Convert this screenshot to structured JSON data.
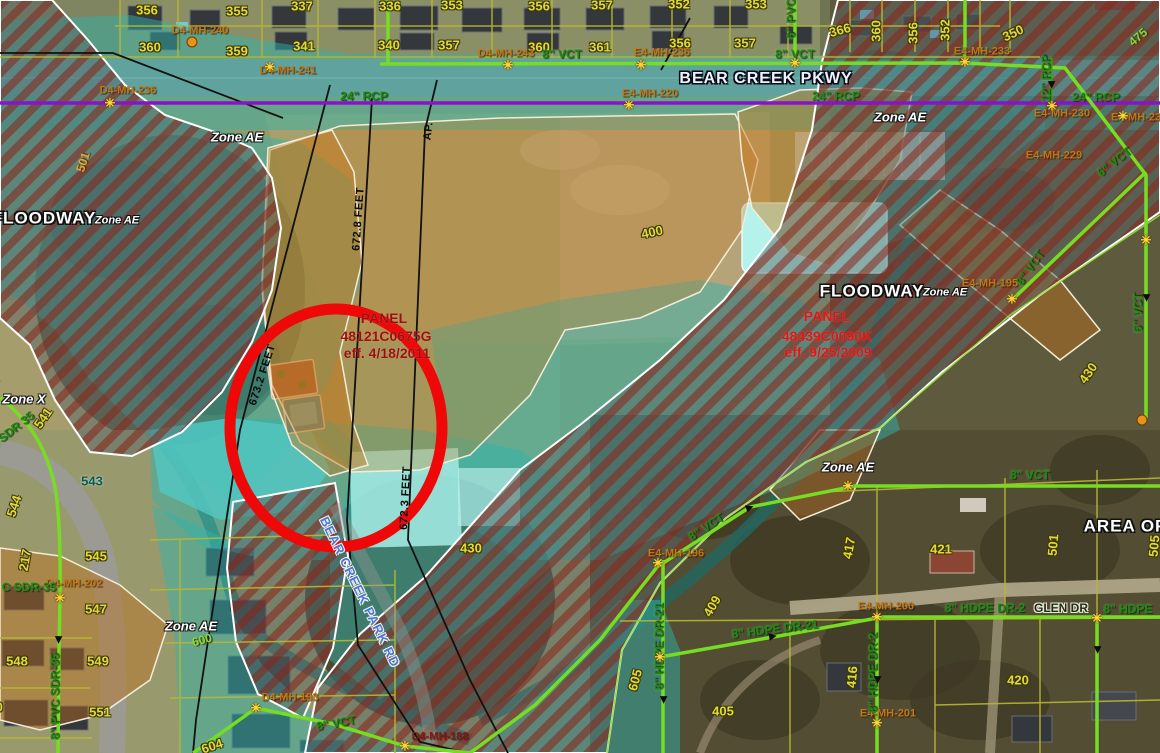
{
  "colors": {
    "zone_teal": "#2fb4ad",
    "floodway_stripe": "#8c2418",
    "orange_zone": "#cf841c",
    "pipe_green": "#76dd22",
    "storm_purple": "#8a12c8",
    "annotation_red": "#ee0808",
    "parcel_yellow": "#e3d83f",
    "mh_orange": "#c07818",
    "panel_dark_red": "#9e1010",
    "panel_bright_red": "#e41414",
    "road_blue": "#4a78d8"
  },
  "panels": {
    "left": {
      "title": "PANEL",
      "number": "48121C0675G",
      "effective": "eff. 4/18/2011"
    },
    "right": {
      "title": "PANEL",
      "number": "48439C0090K",
      "effective": "eff. 9/25/2009"
    }
  },
  "labels": [
    {
      "t": "Zone AE",
      "x": 237,
      "y": 137,
      "c": "zl",
      "n": "zone-ae-label"
    },
    {
      "t": "Zone AE",
      "x": 900,
      "y": 117,
      "c": "zl",
      "n": "zone-ae-label"
    },
    {
      "t": "Zone AE",
      "x": 848,
      "y": 467,
      "c": "zl",
      "n": "zone-ae-label"
    },
    {
      "t": "Zone AE",
      "x": 191,
      "y": 626,
      "c": "zl",
      "n": "zone-ae-label"
    },
    {
      "t": "Zone X",
      "x": 24,
      "y": 399,
      "c": "zl",
      "n": "zone-x-label"
    },
    {
      "t": "FLOODWAY",
      "x": 44,
      "y": 218,
      "c": "fw",
      "n": "floodway-label"
    },
    {
      "t": "Zone AE",
      "x": 117,
      "y": 221,
      "c": "fwz",
      "n": "floodway-zone-label"
    },
    {
      "t": "FLOODWAY",
      "x": 872,
      "y": 291,
      "c": "fw",
      "n": "floodway-label"
    },
    {
      "t": "Zone AE",
      "x": 945,
      "y": 293,
      "c": "fwz",
      "n": "floodway-zone-label"
    },
    {
      "t": "AREA OF",
      "x": 1125,
      "y": 526,
      "c": "fw",
      "n": "area-of-label"
    },
    {
      "t": "PANEL",
      "x": 384,
      "y": 318,
      "c": "p1",
      "n": "panel-title"
    },
    {
      "t": "48121C0675G",
      "x": 386,
      "y": 336,
      "c": "p1",
      "n": "panel-number"
    },
    {
      "t": "eff. 4/18/2011",
      "x": 387,
      "y": 353,
      "c": "p1",
      "n": "panel-effective-date"
    },
    {
      "t": "PANEL",
      "x": 827,
      "y": 316,
      "c": "p2",
      "n": "panel-title"
    },
    {
      "t": "48439C0090K",
      "x": 827,
      "y": 336,
      "c": "p2",
      "n": "panel-number"
    },
    {
      "t": "eff. 9/25/2009",
      "x": 828,
      "y": 352,
      "c": "p2",
      "n": "panel-effective-date"
    },
    {
      "t": "BEAR CREEK PKWY",
      "x": 766,
      "y": 79,
      "c": "st1",
      "n": "street-label"
    },
    {
      "t": "BEAR CREEK PARK RD",
      "x": 360,
      "y": 592,
      "r": 64,
      "c": "st2",
      "n": "street-label"
    },
    {
      "t": "GLEN DR",
      "x": 1061,
      "y": 608,
      "c": "st3",
      "n": "street-label"
    },
    {
      "t": "356",
      "x": 147,
      "y": 10,
      "c": "pc",
      "n": "parcel-label"
    },
    {
      "t": "355",
      "x": 237,
      "y": 11,
      "c": "pc",
      "n": "parcel-label"
    },
    {
      "t": "337",
      "x": 302,
      "y": 6,
      "c": "pc",
      "n": "parcel-label"
    },
    {
      "t": "336",
      "x": 390,
      "y": 6,
      "c": "pc",
      "n": "parcel-label"
    },
    {
      "t": "353",
      "x": 452,
      "y": 5,
      "c": "pc",
      "n": "parcel-label"
    },
    {
      "t": "356",
      "x": 539,
      "y": 6,
      "c": "pc",
      "n": "parcel-label"
    },
    {
      "t": "357",
      "x": 602,
      "y": 5,
      "c": "pc",
      "n": "parcel-label"
    },
    {
      "t": "352",
      "x": 679,
      "y": 4,
      "c": "pc",
      "n": "parcel-label"
    },
    {
      "t": "353",
      "x": 756,
      "y": 4,
      "c": "pc",
      "n": "parcel-label"
    },
    {
      "t": "360",
      "x": 150,
      "y": 47,
      "c": "pc",
      "n": "parcel-label"
    },
    {
      "t": "359",
      "x": 237,
      "y": 51,
      "c": "pc",
      "n": "parcel-label"
    },
    {
      "t": "341",
      "x": 304,
      "y": 46,
      "c": "pc",
      "n": "parcel-label"
    },
    {
      "t": "340",
      "x": 389,
      "y": 45,
      "c": "pc",
      "n": "parcel-label"
    },
    {
      "t": "357",
      "x": 449,
      "y": 45,
      "c": "pc",
      "n": "parcel-label"
    },
    {
      "t": "360",
      "x": 539,
      "y": 47,
      "c": "pc",
      "n": "parcel-label"
    },
    {
      "t": "361",
      "x": 600,
      "y": 47,
      "c": "pc",
      "n": "parcel-label"
    },
    {
      "t": "356",
      "x": 680,
      "y": 43,
      "c": "pc",
      "n": "parcel-label"
    },
    {
      "t": "357",
      "x": 745,
      "y": 43,
      "c": "pc",
      "n": "parcel-label"
    },
    {
      "t": "366",
      "x": 840,
      "y": 30,
      "r": -15,
      "c": "pc",
      "n": "parcel-label"
    },
    {
      "t": "360",
      "x": 876,
      "y": 31,
      "r": -90,
      "c": "pc",
      "n": "parcel-label"
    },
    {
      "t": "356",
      "x": 913,
      "y": 33,
      "r": -90,
      "c": "pc",
      "n": "parcel-label"
    },
    {
      "t": "352",
      "x": 945,
      "y": 30,
      "r": -90,
      "c": "pc",
      "n": "parcel-label"
    },
    {
      "t": "350",
      "x": 1013,
      "y": 33,
      "r": -25,
      "c": "pc",
      "n": "parcel-label"
    },
    {
      "t": "539",
      "x": -8,
      "y": 388,
      "r": -70,
      "c": "pc",
      "n": "parcel-label"
    },
    {
      "t": "541",
      "x": 43,
      "y": 418,
      "r": -55,
      "c": "pc",
      "n": "parcel-label"
    },
    {
      "t": "543",
      "x": 92,
      "y": 481,
      "c": "pcd",
      "n": "parcel-label"
    },
    {
      "t": "544",
      "x": 14,
      "y": 506,
      "r": -72,
      "c": "pc",
      "n": "parcel-label"
    },
    {
      "t": "217",
      "x": 25,
      "y": 560,
      "r": -80,
      "c": "pc",
      "n": "parcel-label"
    },
    {
      "t": "545",
      "x": 96,
      "y": 556,
      "c": "pc",
      "n": "parcel-label"
    },
    {
      "t": "547",
      "x": 96,
      "y": 609,
      "c": "pc",
      "n": "parcel-label"
    },
    {
      "t": "548",
      "x": 17,
      "y": 661,
      "c": "pc",
      "n": "parcel-label"
    },
    {
      "t": "549",
      "x": 98,
      "y": 661,
      "c": "pc",
      "n": "parcel-label"
    },
    {
      "t": "550",
      "x": -8,
      "y": 707,
      "c": "pc",
      "n": "parcel-label"
    },
    {
      "t": "551",
      "x": 100,
      "y": 712,
      "c": "pc",
      "n": "parcel-label"
    },
    {
      "t": "605",
      "x": 635,
      "y": 680,
      "r": -75,
      "c": "pc",
      "n": "parcel-label"
    },
    {
      "t": "400",
      "x": 652,
      "y": 232,
      "r": -12,
      "c": "pc",
      "n": "parcel-label"
    },
    {
      "t": "430",
      "x": 471,
      "y": 548,
      "c": "pc",
      "n": "parcel-label"
    },
    {
      "t": "430",
      "x": 1088,
      "y": 373,
      "r": -55,
      "c": "pc",
      "n": "parcel-label"
    },
    {
      "t": "417",
      "x": 849,
      "y": 548,
      "r": -80,
      "c": "pc",
      "n": "parcel-label"
    },
    {
      "t": "421",
      "x": 941,
      "y": 549,
      "c": "pc",
      "n": "parcel-label"
    },
    {
      "t": "501",
      "x": 1053,
      "y": 545,
      "r": -85,
      "c": "pc",
      "n": "parcel-label"
    },
    {
      "t": "505",
      "x": 1154,
      "y": 546,
      "r": -85,
      "c": "pc",
      "n": "parcel-label"
    },
    {
      "t": "416",
      "x": 852,
      "y": 677,
      "r": -85,
      "c": "pc",
      "n": "parcel-label"
    },
    {
      "t": "409",
      "x": 712,
      "y": 606,
      "r": -60,
      "c": "pc",
      "n": "parcel-label"
    },
    {
      "t": "405",
      "x": 723,
      "y": 711,
      "c": "pc",
      "n": "parcel-label"
    },
    {
      "t": "420",
      "x": 1018,
      "y": 680,
      "c": "pc",
      "n": "parcel-label"
    },
    {
      "t": "604",
      "x": 212,
      "y": 746,
      "r": -18,
      "c": "pc",
      "n": "contour-label"
    },
    {
      "t": "501",
      "x": 83,
      "y": 162,
      "r": -72,
      "c": "co",
      "n": "contour-label"
    },
    {
      "t": "475",
      "x": 1138,
      "y": 37,
      "r": -40,
      "c": "cg",
      "n": "contour-label"
    },
    {
      "t": "600",
      "x": 202,
      "y": 640,
      "r": -15,
      "c": "cg",
      "n": "contour-label"
    },
    {
      "t": "D4-MH-236",
      "x": 128,
      "y": 91,
      "c": "mh",
      "n": "manhole-label"
    },
    {
      "t": "D4-MH-241",
      "x": 288,
      "y": 71,
      "c": "mh",
      "n": "manhole-label"
    },
    {
      "t": "D4-MH-240",
      "x": 200,
      "y": 31,
      "c": "mh",
      "n": "manhole-label"
    },
    {
      "t": "D4-MH-243",
      "x": 506,
      "y": 54,
      "c": "mh",
      "n": "manhole-label"
    },
    {
      "t": "E4-MH-236",
      "x": 662,
      "y": 53,
      "c": "mh",
      "n": "manhole-label"
    },
    {
      "t": "E4-MH-220",
      "x": 650,
      "y": 94,
      "c": "mh",
      "n": "manhole-label"
    },
    {
      "t": "E4-MH-233",
      "x": 982,
      "y": 52,
      "c": "mh",
      "n": "manhole-label"
    },
    {
      "t": "E4-MH-230",
      "x": 1062,
      "y": 114,
      "c": "mh",
      "n": "manhole-label"
    },
    {
      "t": "E4-MH-23",
      "x": 1136,
      "y": 118,
      "c": "mh",
      "n": "manhole-label"
    },
    {
      "t": "E4-MH-229",
      "x": 1054,
      "y": 156,
      "c": "mh",
      "n": "manhole-label"
    },
    {
      "t": "E4-MH-195",
      "x": 990,
      "y": 284,
      "c": "mh",
      "n": "manhole-label"
    },
    {
      "t": "E4-MH-196",
      "x": 676,
      "y": 554,
      "c": "mh",
      "n": "manhole-label"
    },
    {
      "t": "E4-MH-200",
      "x": 886,
      "y": 607,
      "c": "mh",
      "n": "manhole-label"
    },
    {
      "t": "E4-MH-201",
      "x": 888,
      "y": 714,
      "c": "mh",
      "n": "manhole-label"
    },
    {
      "t": "D4-MH-202",
      "x": 74,
      "y": 584,
      "c": "mh",
      "n": "manhole-label"
    },
    {
      "t": "D4-MH-193",
      "x": 290,
      "y": 698,
      "c": "mh",
      "n": "manhole-label"
    },
    {
      "t": "D4-MH-188",
      "x": 440,
      "y": 737,
      "c": "mhd",
      "n": "manhole-label"
    },
    {
      "t": "8\" VCT",
      "x": 562,
      "y": 54,
      "c": "pg",
      "n": "pipe-label"
    },
    {
      "t": "8\" VCT",
      "x": 795,
      "y": 54,
      "c": "pg",
      "n": "pipe-label"
    },
    {
      "t": "6\" PVC",
      "x": 791,
      "y": 19,
      "r": -90,
      "c": "pg",
      "n": "pipe-label"
    },
    {
      "t": "24\" RCP",
      "x": 364,
      "y": 96,
      "c": "pg",
      "n": "pipe-label"
    },
    {
      "t": "24\" RCP",
      "x": 836,
      "y": 96,
      "c": "pg",
      "n": "pipe-label"
    },
    {
      "t": "24\" RCP",
      "x": 1096,
      "y": 97,
      "c": "pg",
      "n": "pipe-label"
    },
    {
      "t": "12\" RCP",
      "x": 1046,
      "y": 79,
      "r": -90,
      "c": "pg",
      "n": "pipe-label"
    },
    {
      "t": "8\" VCT",
      "x": 1030,
      "y": 268,
      "r": -55,
      "c": "pg",
      "n": "pipe-label"
    },
    {
      "t": "8\" VCT",
      "x": 1030,
      "y": 475,
      "c": "pg",
      "n": "pipe-label"
    },
    {
      "t": "8\" VCT",
      "x": 706,
      "y": 527,
      "r": -33,
      "c": "pg",
      "n": "pipe-label"
    },
    {
      "t": "8\" VCT",
      "x": 336,
      "y": 723,
      "r": -10,
      "c": "pg",
      "n": "pipe-label"
    },
    {
      "t": "8\" HDPE DR-21",
      "x": 775,
      "y": 629,
      "r": -7,
      "c": "pg",
      "n": "pipe-label"
    },
    {
      "t": "8\" HDPE DR-2",
      "x": 985,
      "y": 608,
      "c": "pg",
      "n": "pipe-label"
    },
    {
      "t": "8\" HDPE",
      "x": 1128,
      "y": 609,
      "c": "pg",
      "n": "pipe-label"
    },
    {
      "t": "8\" HDPE DR-21",
      "x": 659,
      "y": 647,
      "r": -90,
      "c": "pg",
      "n": "pipe-label"
    },
    {
      "t": "8\" HDPE DR-2",
      "x": 873,
      "y": 673,
      "r": -90,
      "c": "pg",
      "n": "pipe-label"
    },
    {
      "t": "8\" PVC SDR-35",
      "x": 55,
      "y": 697,
      "r": -90,
      "c": "pg",
      "n": "pipe-label"
    },
    {
      "t": "C SDR-35",
      "x": 29,
      "y": 587,
      "c": "pg",
      "n": "pipe-label"
    },
    {
      "t": "SDR 35",
      "x": 16,
      "y": 427,
      "r": -38,
      "c": "pg",
      "n": "pipe-label"
    },
    {
      "t": "6\" VCT",
      "x": 1114,
      "y": 162,
      "r": -38,
      "c": "pg",
      "n": "pipe-label"
    },
    {
      "t": "6\" VCT",
      "x": 1138,
      "y": 313,
      "r": -90,
      "c": "pg",
      "n": "pipe-label"
    },
    {
      "t": "AP.",
      "x": 429,
      "y": 131,
      "r": -83,
      "c": "sx",
      "n": "section-label"
    },
    {
      "t": "672.8 FEET",
      "x": 359,
      "y": 219,
      "r": -86,
      "c": "sx",
      "n": "section-label"
    },
    {
      "t": "673.2 FEET",
      "x": 263,
      "y": 375,
      "r": -72,
      "c": "sx",
      "n": "section-label"
    },
    {
      "t": "672.3 FEET",
      "x": 406,
      "y": 498,
      "r": -87,
      "c": "sx",
      "n": "section-label"
    }
  ],
  "symbols": [
    {
      "k": "sun",
      "x": 110,
      "y": 103
    },
    {
      "k": "sun",
      "x": 270,
      "y": 67
    },
    {
      "k": "sun",
      "x": 508,
      "y": 65
    },
    {
      "k": "sun",
      "x": 641,
      "y": 65
    },
    {
      "k": "sun",
      "x": 795,
      "y": 63
    },
    {
      "k": "sun",
      "x": 965,
      "y": 62
    },
    {
      "k": "sun",
      "x": 629,
      "y": 105
    },
    {
      "k": "sun",
      "x": 1052,
      "y": 106
    },
    {
      "k": "sun",
      "x": 1123,
      "y": 116
    },
    {
      "k": "sun",
      "x": 1012,
      "y": 299
    },
    {
      "k": "sun",
      "x": 1146,
      "y": 240
    },
    {
      "k": "sun",
      "x": 848,
      "y": 486
    },
    {
      "k": "sun",
      "x": 658,
      "y": 563
    },
    {
      "k": "sun",
      "x": 60,
      "y": 598
    },
    {
      "k": "sun",
      "x": 877,
      "y": 617
    },
    {
      "k": "sun",
      "x": 1097,
      "y": 618
    },
    {
      "k": "sun",
      "x": 660,
      "y": 657
    },
    {
      "k": "sun",
      "x": 256,
      "y": 708
    },
    {
      "k": "sun",
      "x": 877,
      "y": 723
    },
    {
      "k": "sun",
      "x": 405,
      "y": 746
    },
    {
      "k": "dot",
      "x": 192,
      "y": 42
    },
    {
      "k": "dot",
      "x": 1142,
      "y": 420
    },
    {
      "k": "arw",
      "x": 750,
      "y": 508,
      "r": -20
    },
    {
      "k": "arw",
      "x": 773,
      "y": 637,
      "r": -8
    },
    {
      "k": "arw",
      "x": 663,
      "y": 700,
      "r": 90
    },
    {
      "k": "arw",
      "x": 877,
      "y": 680,
      "r": 90
    },
    {
      "k": "arw",
      "x": 1097,
      "y": 650,
      "r": 90
    },
    {
      "k": "arw",
      "x": 58,
      "y": 640,
      "r": 90
    },
    {
      "k": "arw",
      "x": 1146,
      "y": 298,
      "r": 90
    },
    {
      "k": "arw",
      "x": 1051,
      "y": 85,
      "r": 90
    }
  ]
}
